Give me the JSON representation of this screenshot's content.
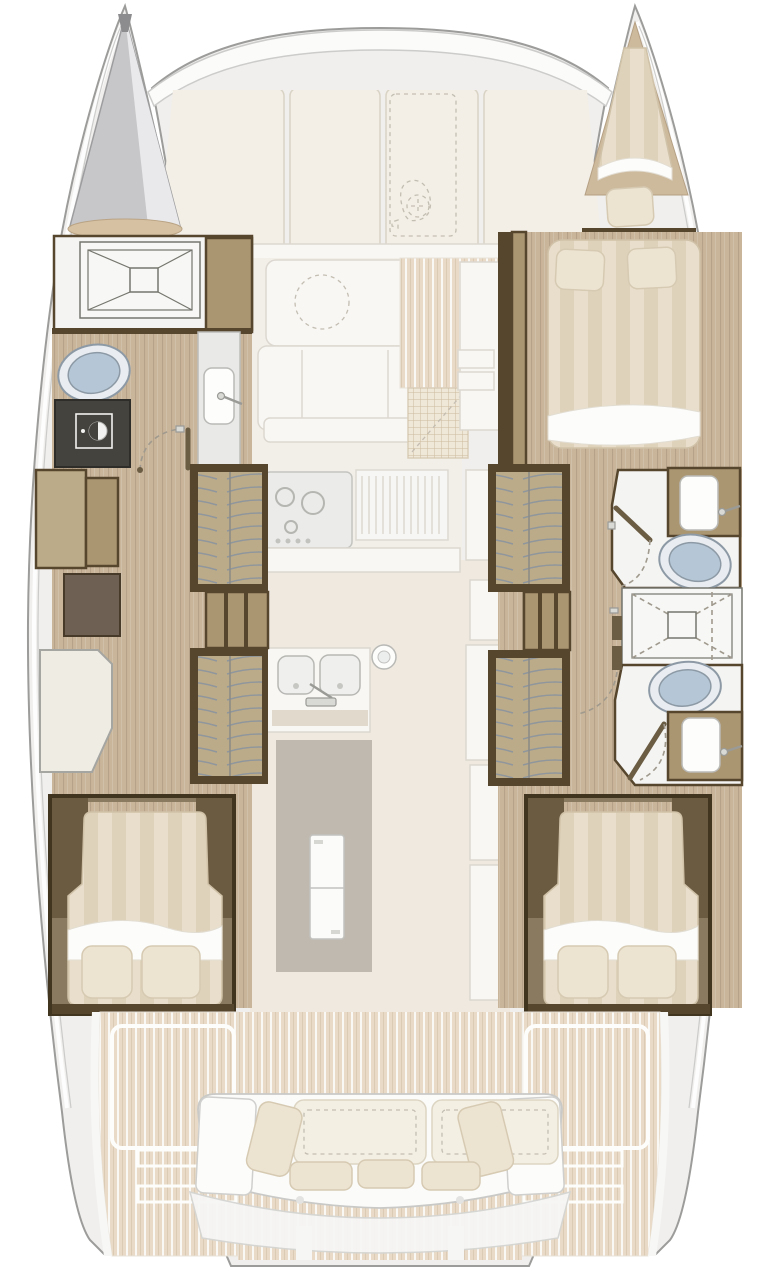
{
  "diagram": {
    "type": "floorplan",
    "subject": "catamaran-interior-deck-plan",
    "orientation": "bow-up",
    "hulls": 2,
    "cabins": 3,
    "bathrooms": 3
  },
  "palette": {
    "hull-fill": "#f0efed",
    "hull-stroke": "#9c9c9a",
    "deck-cream": "#f3efe6",
    "seam": "#d9d3c6",
    "wood-floor": "#c9b59a",
    "wood-grain": "#a6927a",
    "wood-mid": "#ab9672",
    "wood-light": "#bcab88",
    "dark-wood": "#56462e",
    "dark-panel": "#6e6052",
    "deck-plank": "#e8dac6",
    "mattress": "#e9decb",
    "mattress-stripe": "#dfd2ba",
    "pillow": "#ece3d1",
    "porcelain": "#e9edf1",
    "wc-lid": "#b5c7d6",
    "fixture-stroke": "#8d9aa6",
    "faded-white": "#f8f7f4",
    "faded-stroke": "#dcd8d0",
    "appliance-dark": "#45433e"
  },
  "areas": {
    "foredeck": {
      "fixtures": [
        "windlass",
        "deck-panels",
        "anchor-locker"
      ]
    },
    "saloon": {
      "fixtures": [
        "saloon-table",
        "saloon-sofa",
        "companionway-steps",
        "entry-mat"
      ]
    },
    "galley": {
      "fixtures": [
        "stove",
        "drainboard",
        "double-sink",
        "faucet",
        "deck-hatch",
        "refrigerator"
      ]
    },
    "port_hull": {
      "fixtures": [
        "bow-locker",
        "shower-tray",
        "toilet",
        "washing-machine",
        "vanity-sink",
        "cabinet",
        "storage-locker",
        "seat",
        "wardrobe-forward",
        "shelf-unit",
        "wardrobe-aft",
        "double-bed-aft",
        "pillows"
      ]
    },
    "starboard_hull": {
      "fixtures": [
        "v-berth",
        "pillow",
        "double-bed-forward",
        "pillows",
        "wardrobe-forward",
        "bathroom-sink-forward",
        "toilet-forward",
        "shower-tray",
        "toilet-aft",
        "bathroom-sink-aft",
        "shelf-unit",
        "wardrobe-aft",
        "double-bed-aft"
      ]
    },
    "cockpit": {
      "fixtures": [
        "cockpit-sofa",
        "back-cushions",
        "seat-pillows",
        "swim-platform-port",
        "swim-platform-starboard",
        "transom-steps"
      ]
    }
  }
}
